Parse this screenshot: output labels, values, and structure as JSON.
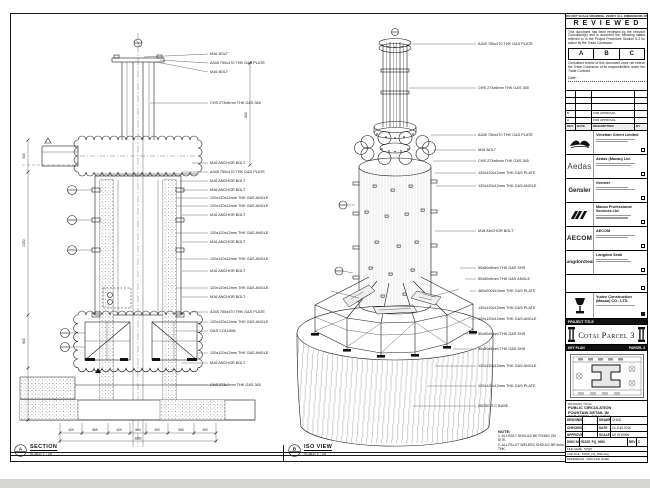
{
  "sheet": {
    "margin_note": "DO NOT SCALE DRAWING. VERIFY ALL DIMENSIONS ON SITE."
  },
  "review": {
    "title": "R E V I E W E D",
    "para1": "This document has been reviewed by the relevant Consultant(s) and is accorded the following status referred to in the Project Procedure Section 5.4 for action by the Trade Contractor.",
    "statuses": [
      "A",
      "B",
      "C"
    ],
    "para2": "Consultant review of this document does not relieve the Trade Contractor of its responsibilities under the Trade Contract.",
    "date_label": "Date :"
  },
  "revisions": {
    "headers": [
      "REV",
      "DATE",
      "DESCRIPTION",
      "BY"
    ],
    "rows": [
      {
        "rev": "",
        "date": "",
        "desc": "",
        "by": ""
      },
      {
        "rev": "",
        "date": "",
        "desc": "",
        "by": ""
      },
      {
        "rev": "",
        "date": "",
        "desc": "",
        "by": ""
      },
      {
        "rev": "B",
        "date": "",
        "desc": "FOR APPROVAL",
        "by": ""
      },
      {
        "rev": "A",
        "date": "",
        "desc": "FOR APPROVAL",
        "by": ""
      }
    ]
  },
  "consultants": [
    {
      "name": "Venetian Orient Limited"
    },
    {
      "name": "Aedas (Macau) Ltd.",
      "logo": "Aedas"
    },
    {
      "name": "Gensler",
      "logo": "Gensler"
    },
    {
      "name": "Macau Professional Services Ltd."
    },
    {
      "name": "AECOM",
      "logo": "AECOM"
    },
    {
      "name": "Langdon Seah",
      "logo": "LangdonSeah"
    }
  ],
  "contractor": {
    "name_line1": "Yudee Construction",
    "name_line2": "(Macau) CO., LTD."
  },
  "project": {
    "band_label": "PROJECT TITLE",
    "name": "Cotai Parcel 3"
  },
  "key_plan": {
    "label": "KEY PLAN",
    "right_label": "PARCEL 3"
  },
  "title_block": {
    "drawing_title_label": "DRAWING TITLE:",
    "line1": "PUBLIC CIRCULATION",
    "line2": "FOUNTAIN DETAIL IN",
    "line3": "FOR STEEL DRAWING",
    "designed_label": "DESIGNED",
    "designed": "-",
    "drawn_label": "DRAWN",
    "drawn": "CHAD",
    "checked_label": "CHECKED",
    "checked": "-",
    "date_label": "DATE",
    "date": "14-JUN-2016",
    "approved_label": "APPROVED",
    "approved": "-",
    "scale_label": "SCALE",
    "scale": "AS SHOWN",
    "dwg_no_label": "DWG NO.",
    "dwg_no": "51525_FQ_0000",
    "rev_label": "REV",
    "rev": "C",
    "file_row1": "FILE NAME : 51525",
    "file_row2": "CAD FILE : 51525_FQ_0000.dwg",
    "file_row3": "REFERENCE : DWG FILE NAME"
  },
  "notes": {
    "heading": "NOTE:",
    "line1": "1. ALL BOLT SHOULD BE FIXING ON SITE.",
    "line2": "2. ALL FILLET WELDED SHOULD BE 6mm THK."
  },
  "views": {
    "section": {
      "bubble": "A",
      "title": "SECTION",
      "scale": "SCALE 1 : 25",
      "callouts": [
        "M16 BOLT",
        "A345 750x470 THK G&S PLATE",
        "M16 BOLT",
        "CHS 273x6mm THK G&S 345",
        "M16 ANCHOR BOLT",
        "A345 750x470 THK G&S PLATE",
        "M16 ANCHOR BOLT",
        "M16 ANCHOR BOLT",
        "120x120x12mm THK G&S ANGLE",
        "120x120x12mm THK G&S ANGLE",
        "M16 ANCHOR BOLT",
        "120x120x12mm THK G&S ANGLE",
        "M16 ANCHOR BOLT",
        "120x120x12mm THK G&S ANGLE",
        "M16 ANCHOR BOLT",
        "120x120x12mm THK G&S ANGLE",
        "M16 ANCHOR BOLT",
        "A345 750x470 THK G&S PLATE",
        "120x120x12mm THK G&S ANGLE",
        "G&S COLUMN",
        "120x120x12mm THK G&S ANGLE",
        "M16 ANCHOR BOLT",
        "CHS 273x6mm THK G&S 345"
      ],
      "dims": {
        "bottom": [
          "400",
          "565",
          "400",
          "550",
          "400",
          "565",
          "400"
        ],
        "bottom_total": "2850",
        "left": [
          "500",
          "2150",
          "800"
        ],
        "right": "800"
      }
    },
    "iso": {
      "bubble": "B",
      "title": "ISO VIEW",
      "scale": "SCALE 1 : 25",
      "callouts": [
        "A345 750x470 THK G&S PLATE",
        "CHS 273x6mm THK G&S 345",
        "A345 750x470 THK G&S PLATE",
        "M16 BOLT",
        "CHS 273x6mm THK G&S 345",
        "120x120x12mm THK G&S PLATE",
        "120x120x12mm THK G&S ANGLE",
        "M16 ANCHOR BOLT",
        "50x50x5mm THK G&S SHS",
        "50x50x5mm THK G&S ANGLE",
        "460x200x10mm THK G&S PLATE",
        "120x120x12mm THK G&S PLATE",
        "120x120x12mm THK G&S ANGLE",
        "50x50x5mm THK G&S SHS",
        "50x50x5mm THK G&S SHS",
        "120x120x12mm THK G&S ANGLE",
        "120x120x12mm THK G&S PLATE",
        "Ø4250 R.C BASE"
      ]
    }
  }
}
